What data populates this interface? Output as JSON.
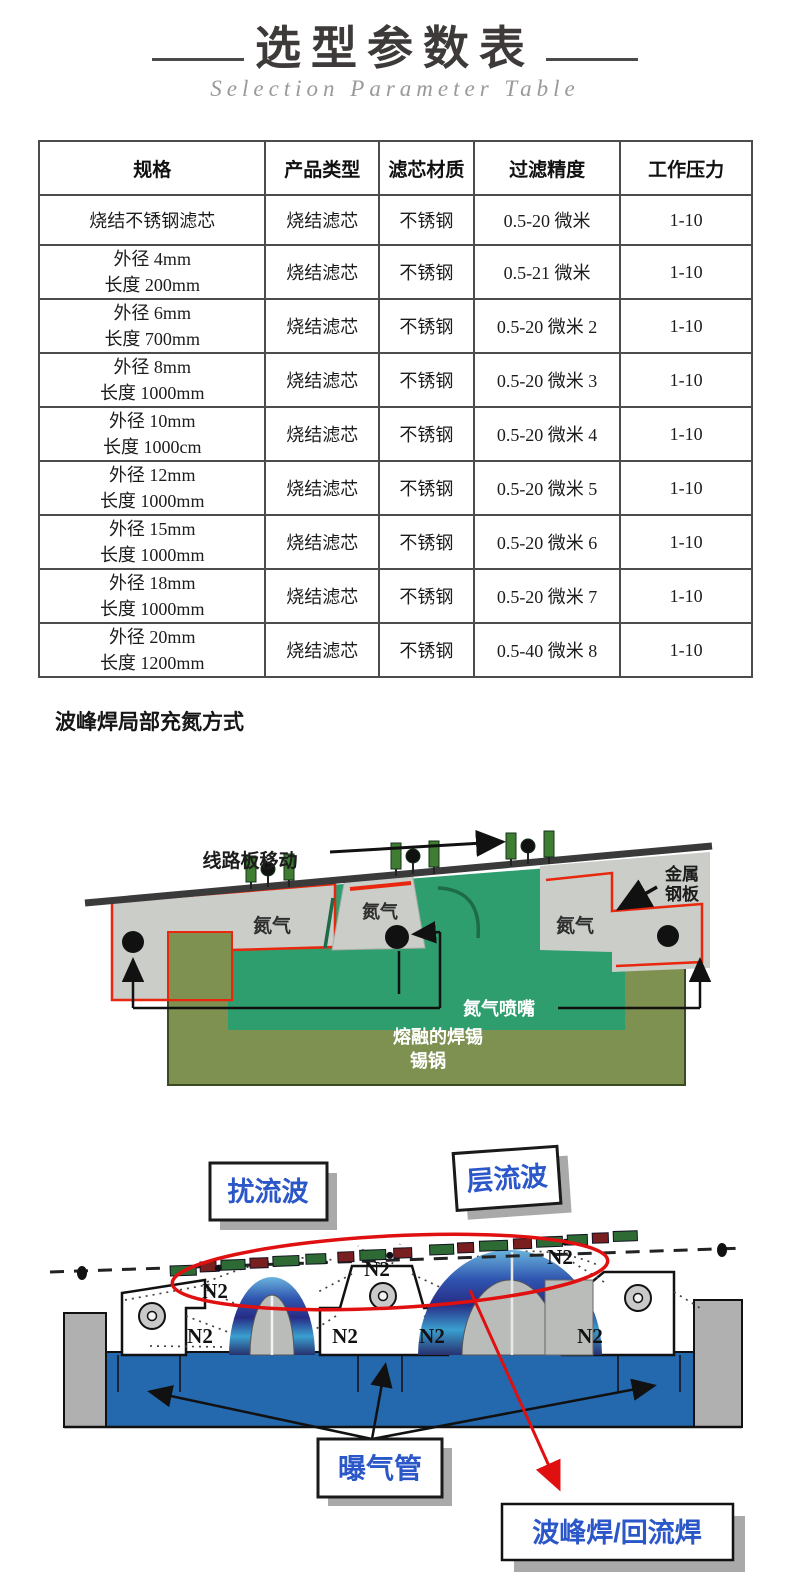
{
  "header": {
    "title": "选型参数表",
    "subtitle": "Selection Parameter Table"
  },
  "table": {
    "headers": [
      "规格",
      "产品类型",
      "滤芯材质",
      "过滤精度",
      "工作压力"
    ],
    "rows": [
      {
        "spec": [
          "烧结不锈钢滤芯",
          ""
        ],
        "type": "烧结滤芯",
        "material": "不锈钢",
        "precision": "0.5-20 微米",
        "pressure": "1-10"
      },
      {
        "spec": [
          "外径 4mm",
          "长度 200mm"
        ],
        "type": "烧结滤芯",
        "material": "不锈钢",
        "precision": "0.5-21 微米",
        "pressure": "1-10"
      },
      {
        "spec": [
          "外径 6mm",
          "长度 700mm"
        ],
        "type": "烧结滤芯",
        "material": "不锈钢",
        "precision": "0.5-20 微米 2",
        "pressure": "1-10"
      },
      {
        "spec": [
          "外径 8mm",
          "长度 1000mm"
        ],
        "type": "烧结滤芯",
        "material": "不锈钢",
        "precision": "0.5-20 微米 3",
        "pressure": "1-10"
      },
      {
        "spec": [
          "外径 10mm",
          "长度 1000cm"
        ],
        "type": "烧结滤芯",
        "material": "不锈钢",
        "precision": "0.5-20 微米 4",
        "pressure": "1-10"
      },
      {
        "spec": [
          "外径 12mm",
          "长度 1000mm"
        ],
        "type": "烧结滤芯",
        "material": "不锈钢",
        "precision": "0.5-20 微米 5",
        "pressure": "1-10"
      },
      {
        "spec": [
          "外径 15mm",
          "长度 1000mm"
        ],
        "type": "烧结滤芯",
        "material": "不锈钢",
        "precision": "0.5-20 微米 6",
        "pressure": "1-10"
      },
      {
        "spec": [
          "外径 18mm",
          "长度 1000mm"
        ],
        "type": "烧结滤芯",
        "material": "不锈钢",
        "precision": "0.5-20 微米 7",
        "pressure": "1-10"
      },
      {
        "spec": [
          "外径 20mm",
          "长度 1200mm"
        ],
        "type": "烧结滤芯",
        "material": "不锈钢",
        "precision": "0.5-40 微米 8",
        "pressure": "1-10"
      }
    ]
  },
  "section": {
    "heading": "波峰焊局部充氮方式"
  },
  "diagram1": {
    "board_move": "线路板移动",
    "nitrogen_left": "氮气",
    "nitrogen_center": "氮气",
    "nitrogen_right": "氮气",
    "metal_plate_l1": "金属",
    "metal_plate_l2": "钢板",
    "nozzle": "氮气喷嘴",
    "molten_solder": "熔融的焊锡",
    "tin_pot": "锡锅"
  },
  "diagram2": {
    "turbulent": "扰流波",
    "laminar": "层流波",
    "n2": "N2",
    "aeration": "曝气管",
    "wave_reflow": "波峰焊/回流焊"
  },
  "colors": {
    "accent_red": "#e01010",
    "solder_teal": "#2f9e6e",
    "pot_olive": "#7e9150",
    "bath_blue": "#2468ae",
    "label_blue": "#2b57c8"
  }
}
